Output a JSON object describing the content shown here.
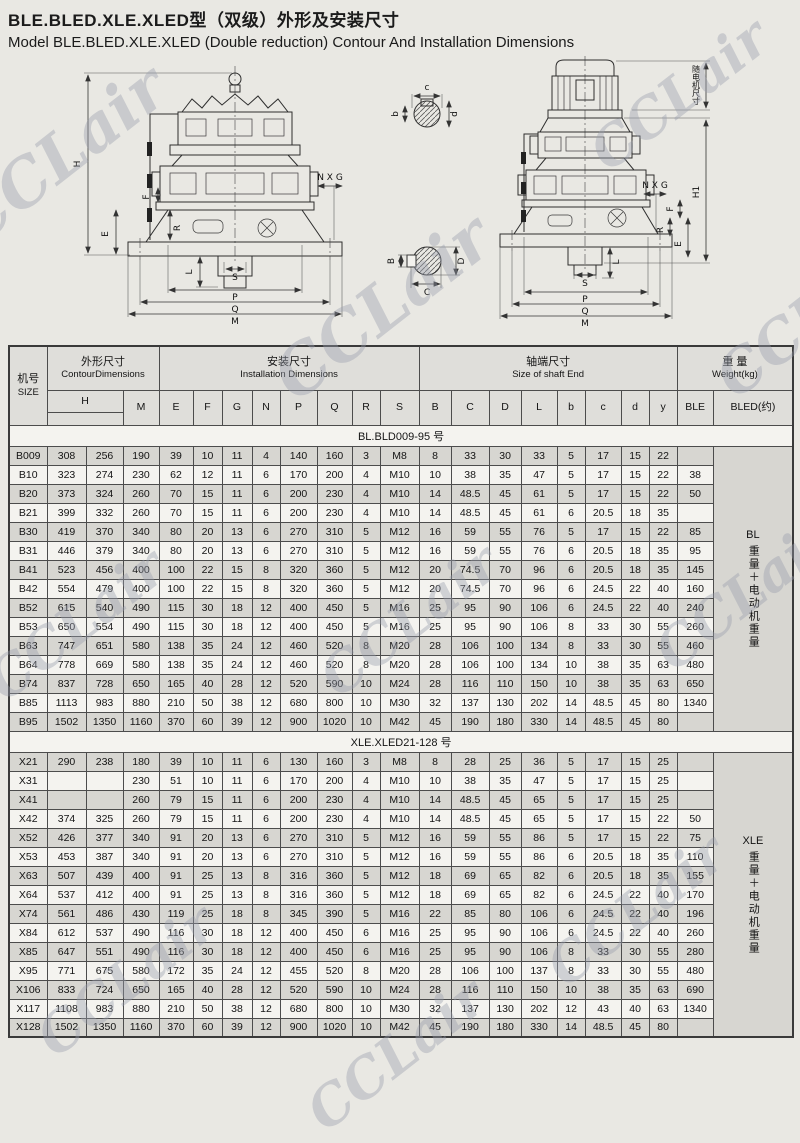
{
  "header": {
    "title_zh": "BLE.BLED.XLE.XLED型（双级）外形及安装尺寸",
    "title_en": "Model BLE.BLED.XLE.XLED  (Double  reduction) Contour And Installation Dimensions"
  },
  "watermark": {
    "text": "CCLair"
  },
  "drawing": {
    "left_labels": {
      "h": "H",
      "f": "F",
      "e": "E",
      "r": "R",
      "nxg": "N X G",
      "l": "L",
      "s": "S",
      "p": "P",
      "q": "Q",
      "m": "M"
    },
    "right_labels": {
      "motor_note": "随电机尺寸",
      "h1": "H1",
      "nxg": "N X G",
      "f": "F",
      "r": "R",
      "e": "E",
      "l": "L",
      "s": "S",
      "p": "P",
      "q": "Q",
      "m": "M"
    },
    "input_shaft_labels": {
      "b": "b",
      "c": "c",
      "d": "d"
    },
    "output_shaft_labels": {
      "b": "B",
      "c": "C",
      "d": "D"
    }
  },
  "table": {
    "header": {
      "size_zh": "机号",
      "size_en": "SIZE",
      "contour_zh": "外形尺寸",
      "contour_en": "ContourDimensions",
      "install_zh": "安装尺寸",
      "install_en": "Installation   Dimensions",
      "shaft_zh": "轴端尺寸",
      "shaft_en": "Size of shaft End",
      "weight_zh": "重 量",
      "weight_en": "Weight(kg)",
      "h": "H",
      "m": "M",
      "e": "E",
      "f": "F",
      "g": "G",
      "n": "N",
      "p": "P",
      "q": "Q",
      "r": "R",
      "s": "S",
      "b": "B",
      "c": "C",
      "d": "D",
      "l": "L",
      "b2": "b",
      "c2": "c",
      "d2": "d",
      "y": "y",
      "ble": "BLE",
      "bled": "BLED(约)"
    },
    "sections": [
      {
        "label": "BL.BLD009-95 号",
        "side": {
          "prefix": "BL",
          "vertical": "重量＋电动机重量"
        },
        "rows": [
          {
            "size": "B009",
            "values": [
              "308",
              "256",
              "190",
              "39",
              "10",
              "11",
              "4",
              "140",
              "160",
              "3",
              "M8",
              "8",
              "33",
              "30",
              "33",
              "5",
              "17",
              "15",
              "22",
              ""
            ]
          },
          {
            "size": "B10",
            "values": [
              "323",
              "274",
              "230",
              "62",
              "12",
              "11",
              "6",
              "170",
              "200",
              "4",
              "M10",
              "10",
              "38",
              "35",
              "47",
              "5",
              "17",
              "15",
              "22",
              "38"
            ]
          },
          {
            "size": "B20",
            "values": [
              "373",
              "324",
              "260",
              "70",
              "15",
              "11",
              "6",
              "200",
              "230",
              "4",
              "M10",
              "14",
              "48.5",
              "45",
              "61",
              "5",
              "17",
              "15",
              "22",
              "50"
            ]
          },
          {
            "size": "B21",
            "values": [
              "399",
              "332",
              "260",
              "70",
              "15",
              "11",
              "6",
              "200",
              "230",
              "4",
              "M10",
              "14",
              "48.5",
              "45",
              "61",
              "6",
              "20.5",
              "18",
              "35",
              ""
            ]
          },
          {
            "size": "B30",
            "values": [
              "419",
              "370",
              "340",
              "80",
              "20",
              "13",
              "6",
              "270",
              "310",
              "5",
              "M12",
              "16",
              "59",
              "55",
              "76",
              "5",
              "17",
              "15",
              "22",
              "85"
            ]
          },
          {
            "size": "B31",
            "values": [
              "446",
              "379",
              "340",
              "80",
              "20",
              "13",
              "6",
              "270",
              "310",
              "5",
              "M12",
              "16",
              "59",
              "55",
              "76",
              "6",
              "20.5",
              "18",
              "35",
              "95"
            ]
          },
          {
            "size": "B41",
            "values": [
              "523",
              "456",
              "400",
              "100",
              "22",
              "15",
              "8",
              "320",
              "360",
              "5",
              "M12",
              "20",
              "74.5",
              "70",
              "96",
              "6",
              "20.5",
              "18",
              "35",
              "145"
            ]
          },
          {
            "size": "B42",
            "values": [
              "554",
              "479",
              "400",
              "100",
              "22",
              "15",
              "8",
              "320",
              "360",
              "5",
              "M12",
              "20",
              "74.5",
              "70",
              "96",
              "6",
              "24.5",
              "22",
              "40",
              "160"
            ]
          },
          {
            "size": "B52",
            "values": [
              "615",
              "540",
              "490",
              "115",
              "30",
              "18",
              "12",
              "400",
              "450",
              "5",
              "M16",
              "25",
              "95",
              "90",
              "106",
              "6",
              "24.5",
              "22",
              "40",
              "240"
            ]
          },
          {
            "size": "B53",
            "values": [
              "650",
              "554",
              "490",
              "115",
              "30",
              "18",
              "12",
              "400",
              "450",
              "5",
              "M16",
              "25",
              "95",
              "90",
              "106",
              "8",
              "33",
              "30",
              "55",
              "260"
            ]
          },
          {
            "size": "B63",
            "values": [
              "747",
              "651",
              "580",
              "138",
              "35",
              "24",
              "12",
              "460",
              "520",
              "8",
              "M20",
              "28",
              "106",
              "100",
              "134",
              "8",
              "33",
              "30",
              "55",
              "460"
            ]
          },
          {
            "size": "B64",
            "values": [
              "778",
              "669",
              "580",
              "138",
              "35",
              "24",
              "12",
              "460",
              "520",
              "8",
              "M20",
              "28",
              "106",
              "100",
              "134",
              "10",
              "38",
              "35",
              "63",
              "480"
            ]
          },
          {
            "size": "B74",
            "values": [
              "837",
              "728",
              "650",
              "165",
              "40",
              "28",
              "12",
              "520",
              "590",
              "10",
              "M24",
              "28",
              "116",
              "110",
              "150",
              "10",
              "38",
              "35",
              "63",
              "650"
            ]
          },
          {
            "size": "B85",
            "values": [
              "1113",
              "983",
              "880",
              "210",
              "50",
              "38",
              "12",
              "680",
              "800",
              "10",
              "M30",
              "32",
              "137",
              "130",
              "202",
              "14",
              "48.5",
              "45",
              "80",
              "1340"
            ]
          },
          {
            "size": "B95",
            "values": [
              "1502",
              "1350",
              "1160",
              "370",
              "60",
              "39",
              "12",
              "900",
              "1020",
              "10",
              "M42",
              "45",
              "190",
              "180",
              "330",
              "14",
              "48.5",
              "45",
              "80",
              ""
            ]
          }
        ]
      },
      {
        "label": "XLE.XLED21-128 号",
        "side": {
          "prefix": "XLE",
          "vertical": "重量＋电动机重量"
        },
        "rows": [
          {
            "size": "X21",
            "values": [
              "290",
              "238",
              "180",
              "39",
              "10",
              "11",
              "6",
              "130",
              "160",
              "3",
              "M8",
              "8",
              "28",
              "25",
              "36",
              "5",
              "17",
              "15",
              "25",
              ""
            ]
          },
          {
            "size": "X31",
            "values": [
              "",
              "",
              "230",
              "51",
              "10",
              "11",
              "6",
              "170",
              "200",
              "4",
              "M10",
              "10",
              "38",
              "35",
              "47",
              "5",
              "17",
              "15",
              "25",
              ""
            ]
          },
          {
            "size": "X41",
            "values": [
              "",
              "",
              "260",
              "79",
              "15",
              "11",
              "6",
              "200",
              "230",
              "4",
              "M10",
              "14",
              "48.5",
              "45",
              "65",
              "5",
              "17",
              "15",
              "25",
              ""
            ]
          },
          {
            "size": "X42",
            "values": [
              "374",
              "325",
              "260",
              "79",
              "15",
              "11",
              "6",
              "200",
              "230",
              "4",
              "M10",
              "14",
              "48.5",
              "45",
              "65",
              "5",
              "17",
              "15",
              "22",
              "50"
            ]
          },
          {
            "size": "X52",
            "values": [
              "426",
              "377",
              "340",
              "91",
              "20",
              "13",
              "6",
              "270",
              "310",
              "5",
              "M12",
              "16",
              "59",
              "55",
              "86",
              "5",
              "17",
              "15",
              "22",
              "75"
            ]
          },
          {
            "size": "X53",
            "values": [
              "453",
              "387",
              "340",
              "91",
              "20",
              "13",
              "6",
              "270",
              "310",
              "5",
              "M12",
              "16",
              "59",
              "55",
              "86",
              "6",
              "20.5",
              "18",
              "35",
              "110"
            ]
          },
          {
            "size": "X63",
            "values": [
              "507",
              "439",
              "400",
              "91",
              "25",
              "13",
              "8",
              "316",
              "360",
              "5",
              "M12",
              "18",
              "69",
              "65",
              "82",
              "6",
              "20.5",
              "18",
              "35",
              "155"
            ]
          },
          {
            "size": "X64",
            "values": [
              "537",
              "412",
              "400",
              "91",
              "25",
              "13",
              "8",
              "316",
              "360",
              "5",
              "M12",
              "18",
              "69",
              "65",
              "82",
              "6",
              "24.5",
              "22",
              "40",
              "170"
            ]
          },
          {
            "size": "X74",
            "values": [
              "561",
              "486",
              "430",
              "119",
              "25",
              "18",
              "8",
              "345",
              "390",
              "5",
              "M16",
              "22",
              "85",
              "80",
              "106",
              "6",
              "24.5",
              "22",
              "40",
              "196"
            ]
          },
          {
            "size": "X84",
            "values": [
              "612",
              "537",
              "490",
              "116",
              "30",
              "18",
              "12",
              "400",
              "450",
              "6",
              "M16",
              "25",
              "95",
              "90",
              "106",
              "6",
              "24.5",
              "22",
              "40",
              "260"
            ]
          },
          {
            "size": "X85",
            "values": [
              "647",
              "551",
              "490",
              "116",
              "30",
              "18",
              "12",
              "400",
              "450",
              "6",
              "M16",
              "25",
              "95",
              "90",
              "106",
              "8",
              "33",
              "30",
              "55",
              "280"
            ]
          },
          {
            "size": "X95",
            "values": [
              "771",
              "675",
              "580",
              "172",
              "35",
              "24",
              "12",
              "455",
              "520",
              "8",
              "M20",
              "28",
              "106",
              "100",
              "137",
              "8",
              "33",
              "30",
              "55",
              "480"
            ]
          },
          {
            "size": "X106",
            "values": [
              "833",
              "724",
              "650",
              "165",
              "40",
              "28",
              "12",
              "520",
              "590",
              "10",
              "M24",
              "28",
              "116",
              "110",
              "150",
              "10",
              "38",
              "35",
              "63",
              "690"
            ]
          },
          {
            "size": "X117",
            "values": [
              "1108",
              "983",
              "880",
              "210",
              "50",
              "38",
              "12",
              "680",
              "800",
              "10",
              "M30",
              "32",
              "137",
              "130",
              "202",
              "12",
              "43",
              "40",
              "63",
              "1340"
            ]
          },
          {
            "size": "X128",
            "values": [
              "1502",
              "1350",
              "1160",
              "370",
              "60",
              "39",
              "12",
              "900",
              "1020",
              "10",
              "M42",
              "45",
              "190",
              "180",
              "330",
              "14",
              "48.5",
              "45",
              "80",
              ""
            ]
          }
        ]
      }
    ]
  }
}
